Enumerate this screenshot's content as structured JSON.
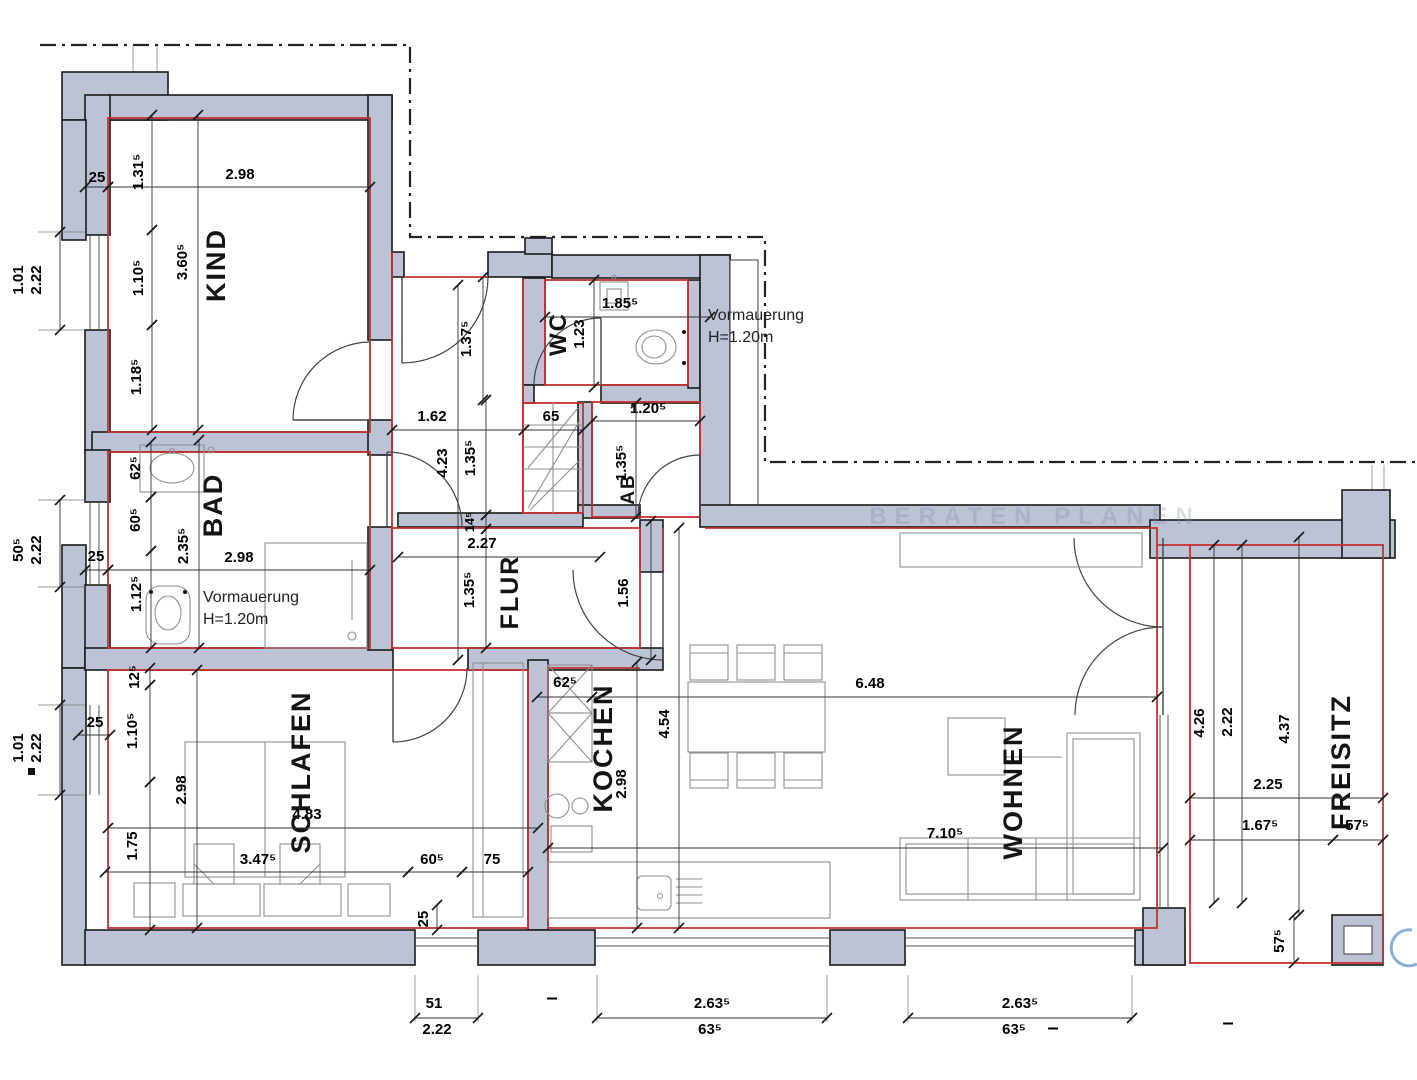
{
  "plan": {
    "watermark": "BERATEN PLANEN",
    "rooms": [
      {
        "id": "kind",
        "label": "KIND",
        "x": 225,
        "y": 265,
        "size": 27
      },
      {
        "id": "wc",
        "label": "WC",
        "x": 566,
        "y": 334,
        "size": 24
      },
      {
        "id": "bad",
        "label": "BAD",
        "x": 222,
        "y": 505,
        "size": 27
      },
      {
        "id": "ab",
        "label": "AB",
        "x": 634,
        "y": 489,
        "size": 19
      },
      {
        "id": "flur",
        "label": "FLUR",
        "x": 518,
        "y": 592,
        "size": 25
      },
      {
        "id": "schlafen",
        "label": "SCHLAFEN",
        "x": 310,
        "y": 772,
        "size": 27
      },
      {
        "id": "kochen",
        "label": "KOCHEN",
        "x": 612,
        "y": 748,
        "size": 27
      },
      {
        "id": "wohnen",
        "label": "WOHNEN",
        "x": 1022,
        "y": 792,
        "size": 27
      },
      {
        "id": "freisitz",
        "label": "FREISITZ",
        "x": 1350,
        "y": 762,
        "size": 27
      }
    ],
    "annotations": [
      {
        "id": "vormauerung-wc",
        "lines": [
          "Vormauerung",
          "H=1.20m"
        ],
        "x": 708,
        "y": 320
      },
      {
        "id": "vormauerung-bad",
        "lines": [
          "Vormauerung",
          "H=1.20m"
        ],
        "x": 203,
        "y": 602
      }
    ],
    "dimensions": [
      {
        "text": "25",
        "x": 97,
        "y": 182,
        "line": [
          85,
          187,
          108,
          187
        ]
      },
      {
        "text": "2.98",
        "x": 240,
        "y": 179,
        "line": [
          108,
          187,
          370,
          187
        ]
      },
      {
        "text": "1.31⁵",
        "x": 143,
        "y": 172,
        "rot": 1,
        "line": [
          152,
          115,
          152,
          230
        ]
      },
      {
        "text": "1.10⁵",
        "x": 143,
        "y": 278,
        "rot": 1,
        "line": [
          152,
          230,
          152,
          325
        ]
      },
      {
        "text": "1.18⁵",
        "x": 141,
        "y": 377,
        "rot": 1,
        "line": [
          152,
          325,
          152,
          430
        ]
      },
      {
        "text": "3.60⁵",
        "x": 187,
        "y": 262,
        "rot": 1,
        "line": [
          198,
          115,
          198,
          430
        ]
      },
      {
        "text": "1.01",
        "x": 23,
        "y": 280,
        "rot": 1
      },
      {
        "text": "2.22",
        "x": 41,
        "y": 280,
        "rot": 1,
        "line": [
          60,
          232,
          60,
          330
        ]
      },
      {
        "text": "50⁵",
        "x": 23,
        "y": 550,
        "rot": 1
      },
      {
        "text": "2.22",
        "x": 41,
        "y": 550,
        "rot": 1,
        "line": [
          60,
          500,
          60,
          587
        ]
      },
      {
        "text": "1.01",
        "x": 23,
        "y": 748,
        "rot": 1
      },
      {
        "text": "2.22",
        "x": 41,
        "y": 748,
        "rot": 1,
        "line": [
          60,
          705,
          60,
          795
        ]
      },
      {
        "text": "25",
        "x": 96,
        "y": 561,
        "line": [
          85,
          570,
          108,
          570
        ]
      },
      {
        "text": "2.98",
        "x": 239,
        "y": 562,
        "line": [
          108,
          570,
          370,
          570
        ]
      },
      {
        "text": "62⁵",
        "x": 140,
        "y": 468,
        "rot": 1,
        "line": [
          151,
          442,
          151,
          497
        ]
      },
      {
        "text": "60⁵",
        "x": 140,
        "y": 520,
        "rot": 1,
        "line": [
          151,
          497,
          151,
          551
        ]
      },
      {
        "text": "1.12⁵",
        "x": 141,
        "y": 594,
        "rot": 1,
        "line": [
          151,
          551,
          151,
          648
        ]
      },
      {
        "text": "2.35⁵",
        "x": 188,
        "y": 546,
        "rot": 1,
        "line": [
          199,
          440,
          199,
          648
        ]
      },
      {
        "text": "25",
        "x": 95,
        "y": 727,
        "line": [
          78,
          735,
          110,
          735
        ]
      },
      {
        "text": "12⁵",
        "x": 139,
        "y": 677,
        "rot": 1,
        "line": [
          150,
          668,
          150,
          685
        ]
      },
      {
        "text": "1.10⁵",
        "x": 137,
        "y": 731,
        "rot": 1,
        "line": [
          150,
          685,
          150,
          782
        ]
      },
      {
        "text": "1.75",
        "x": 137,
        "y": 846,
        "rot": 1,
        "line": [
          150,
          782,
          150,
          930
        ]
      },
      {
        "text": "2.98",
        "x": 186,
        "y": 790,
        "rot": 1,
        "line": [
          197,
          670,
          197,
          928
        ]
      },
      {
        "text": "4.83",
        "x": 307,
        "y": 819,
        "line": [
          108,
          828,
          538,
          828
        ]
      },
      {
        "text": "3.47⁵",
        "x": 258,
        "y": 864,
        "line": [
          105,
          872,
          408,
          872
        ]
      },
      {
        "text": "60⁵",
        "x": 432,
        "y": 864,
        "line": [
          408,
          872,
          462,
          872
        ]
      },
      {
        "text": "75",
        "x": 492,
        "y": 864,
        "line": [
          462,
          872,
          528,
          872
        ]
      },
      {
        "text": "25",
        "x": 428,
        "y": 919,
        "rot": 1,
        "line": [
          437,
          905,
          437,
          930
        ]
      },
      {
        "text": "51",
        "x": 434,
        "y": 1008,
        "line": [
          415,
          1018,
          478,
          1018
        ]
      },
      {
        "text": "2.22",
        "x": 437,
        "y": 1034
      },
      {
        "text": "2.63⁵",
        "x": 712,
        "y": 1008,
        "line": [
          597,
          1018,
          827,
          1018
        ]
      },
      {
        "text": "63⁵",
        "x": 710,
        "y": 1034
      },
      {
        "text": "–",
        "x": 552,
        "y": 1004,
        "size": 20
      },
      {
        "text": "2.63⁵",
        "x": 1020,
        "y": 1008,
        "line": [
          908,
          1018,
          1132,
          1018
        ]
      },
      {
        "text": "63⁵",
        "x": 1014,
        "y": 1034
      },
      {
        "text": "–",
        "x": 1053,
        "y": 1034,
        "size": 20
      },
      {
        "text": "–",
        "x": 1228,
        "y": 1029,
        "size": 20
      },
      {
        "text": "1.37⁵",
        "x": 471,
        "y": 339,
        "rot": 1,
        "line": [
          483,
          277,
          483,
          400
        ]
      },
      {
        "text": "1.62",
        "x": 432,
        "y": 421,
        "line": [
          392,
          430,
          524,
          430
        ]
      },
      {
        "text": "65",
        "x": 551,
        "y": 421,
        "line": [
          524,
          430,
          583,
          430
        ]
      },
      {
        "text": "1.85⁵",
        "x": 620,
        "y": 308,
        "line": [
          545,
          317,
          710,
          317
        ]
      },
      {
        "text": "1.23",
        "x": 584,
        "y": 334,
        "rot": 1,
        "line": [
          594,
          280,
          594,
          387
        ]
      },
      {
        "text": "1.20⁵",
        "x": 648,
        "y": 413,
        "line": [
          592,
          421,
          700,
          421
        ]
      },
      {
        "text": "1.35⁵",
        "x": 626,
        "y": 463,
        "rot": 1,
        "line": [
          636,
          403,
          636,
          517
        ]
      },
      {
        "text": "4.23",
        "x": 447,
        "y": 463,
        "rot": 1,
        "line": [
          458,
          285,
          458,
          660
        ]
      },
      {
        "text": "1.35⁵",
        "x": 475,
        "y": 458,
        "rot": 1,
        "line": [
          486,
          400,
          486,
          515
        ]
      },
      {
        "text": "14⁵",
        "x": 474,
        "y": 522,
        "rot": 1,
        "size": 13,
        "line": [
          486,
          515,
          486,
          529
        ]
      },
      {
        "text": "1.35⁵",
        "x": 474,
        "y": 590,
        "rot": 1,
        "line": [
          486,
          529,
          486,
          648
        ]
      },
      {
        "text": "2.27",
        "x": 482,
        "y": 548,
        "line": [
          398,
          557,
          600,
          557
        ]
      },
      {
        "text": "1.56",
        "x": 628,
        "y": 593,
        "rot": 1,
        "line": [
          651,
          521,
          651,
          660
        ]
      },
      {
        "text": "62⁵",
        "x": 565,
        "y": 687,
        "line": [
          537,
          697,
          592,
          697
        ]
      },
      {
        "text": "6.48",
        "x": 870,
        "y": 688,
        "line": [
          592,
          697,
          1157,
          697
        ]
      },
      {
        "text": "2.98",
        "x": 626,
        "y": 784,
        "rot": 1,
        "line": [
          637,
          662,
          637,
          928
        ]
      },
      {
        "text": "4.54",
        "x": 669,
        "y": 724,
        "rot": 1,
        "line": [
          679,
          528,
          679,
          928
        ]
      },
      {
        "text": "7.10⁵",
        "x": 945,
        "y": 838,
        "line": [
          548,
          848,
          1163,
          848
        ]
      },
      {
        "text": "4.26",
        "x": 1204,
        "y": 723,
        "rot": 1,
        "line": [
          1214,
          545,
          1214,
          903
        ]
      },
      {
        "text": "2.22",
        "x": 1232,
        "y": 722,
        "rot": 1,
        "line": [
          1242,
          545,
          1242,
          903
        ]
      },
      {
        "text": "4.37",
        "x": 1289,
        "y": 729,
        "rot": 1,
        "line": [
          1299,
          537,
          1299,
          915
        ]
      },
      {
        "text": "2.25",
        "x": 1268,
        "y": 789,
        "line": [
          1190,
          798,
          1383,
          798
        ]
      },
      {
        "text": "1.67⁵",
        "x": 1260,
        "y": 830,
        "line": [
          1190,
          840,
          1333,
          840
        ]
      },
      {
        "text": "57⁵",
        "x": 1357,
        "y": 830,
        "line": [
          1333,
          840,
          1383,
          840
        ]
      },
      {
        "text": "57⁵",
        "x": 1284,
        "y": 941,
        "rot": 1,
        "line": [
          1294,
          915,
          1294,
          963
        ]
      }
    ],
    "colors": {
      "wall_fill": "#bcc3d4",
      "outline": "#1b1b1b",
      "room_boundary_red": "#c43131",
      "dimension_text": "#000000",
      "furniture": "#8f8f8f",
      "watermark": "#7e8aa6",
      "logo_blue": "#2a6db5"
    }
  }
}
